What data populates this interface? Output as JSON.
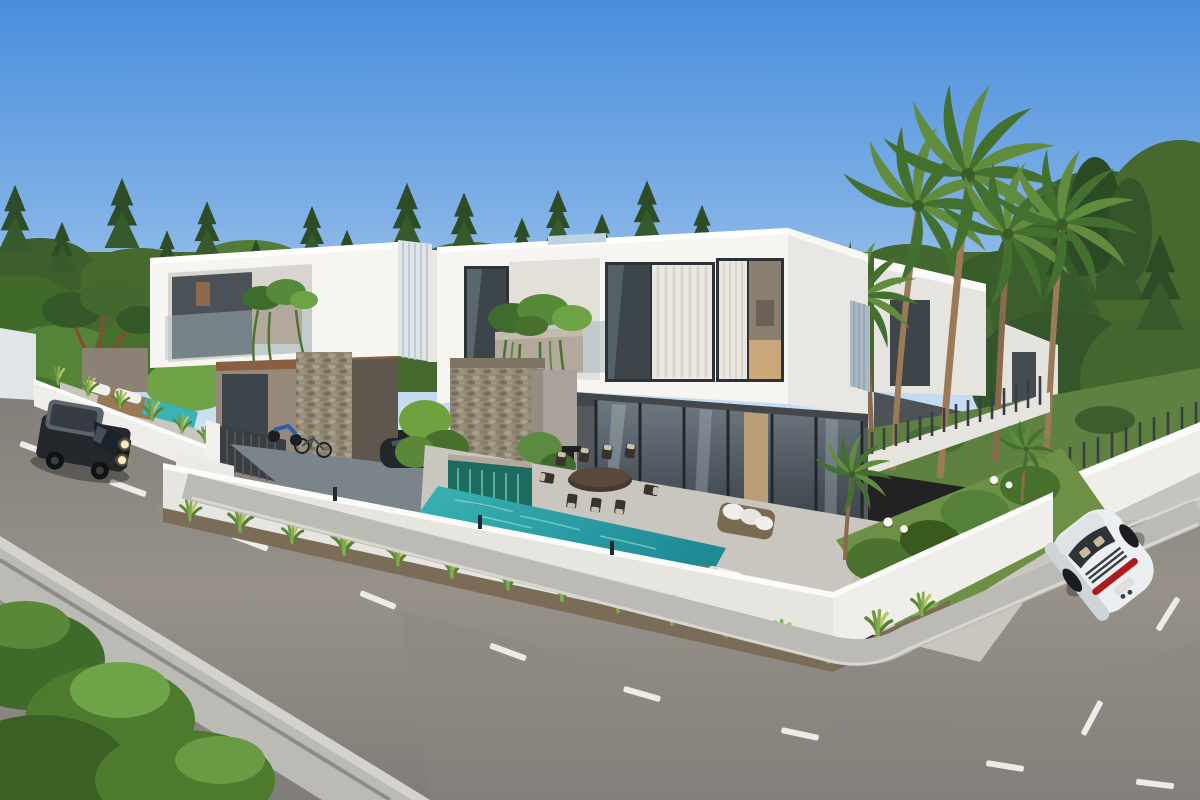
{
  "scene": {
    "description": "3D architectural rendering of a modern two-storey villa development along a curved asphalt street, with swimming pool, tropical landscaping, tall palm trees, a dark SUV driving on the left road and a white sports car on the right road",
    "time_of_day": "daytime, clear blue sky",
    "buildings": [
      {
        "name": "left-villa",
        "floors": 2,
        "style": "white cantilevered upper box, taupe lower walls, stone entry column, balcony planter"
      },
      {
        "name": "main-villa",
        "floors": 2,
        "style": "white upper box with glass walls and sheer curtains, dark concrete ground floor, stone feature wall, outdoor fireplace"
      },
      {
        "name": "rear-villas",
        "count": 2,
        "style": "white boxes receding behind palm grove"
      }
    ],
    "landscape": {
      "palm_trees": 6,
      "background": "dense conifer and broadleaf treeline",
      "pool": "turquoise infinity pool with emerald mosaic waterfall wall",
      "garden": "white perimeter walls with slat fencing, grass tufts, bushes, globe lamps",
      "furniture": "outdoor dining table with eight chairs, wicker sofa, sun loungers"
    },
    "road": {
      "surface": "asphalt",
      "marking": "white dashed center line",
      "sidewalks": "concrete curbs and walkways around the villa corner"
    },
    "vehicles": [
      {
        "type": "suv",
        "color_name": "dark charcoal",
        "position": "left road, driving toward viewer, headlights on"
      },
      {
        "type": "sports-car",
        "color_name": "white",
        "position": "right road, seen from rear"
      },
      {
        "type": "parked-car",
        "color_name": "dark",
        "position": "driveway behind perimeter wall"
      },
      {
        "type": "motorbike-and-bicycle",
        "position": "left villa courtyard"
      }
    ]
  },
  "colors": {
    "sky_top": "#4a8edc",
    "sky_mid": "#7fb0e6",
    "sky_horizon": "#cfe2f2",
    "foliage_dark": "#2e4c26",
    "foliage_mid": "#47682f",
    "foliage_light": "#6fa348",
    "palm_frond": "#44702f",
    "palm_frond_light": "#618c3e",
    "palm_trunk": "#9b7a58",
    "villa_white": "#f6f5f1",
    "villa_white_shade": "#e6e4df",
    "planter_taupe": "#b2a89b",
    "stone_beige": "#968c78",
    "lower_concrete": "#55595d",
    "glass_dark": "#3d454b",
    "glass_reflect": "#7c8890",
    "curtain_white": "#eae6e0",
    "pool_teal": "#3ab3b4",
    "pool_deep": "#1f8a96",
    "waterfall_emerald": "#1d6b5f",
    "patio_tile": "#c9c6bf",
    "asphalt": "#97918a",
    "asphalt_dark": "#807d78",
    "sidewalk": "#bcbab4",
    "soil": "#7b6c58",
    "lawn": "#5e8040",
    "wall_white": "#efeeea",
    "fence_dark": "#3a3e42",
    "wood_brown": "#8a5f3f",
    "suv_body": "#24272c",
    "sports_car_body": "#eceff1",
    "taillight_red": "#b01a1a",
    "lane_marking": "#ecebe6",
    "headlight_glow": "#ffe9b8"
  }
}
